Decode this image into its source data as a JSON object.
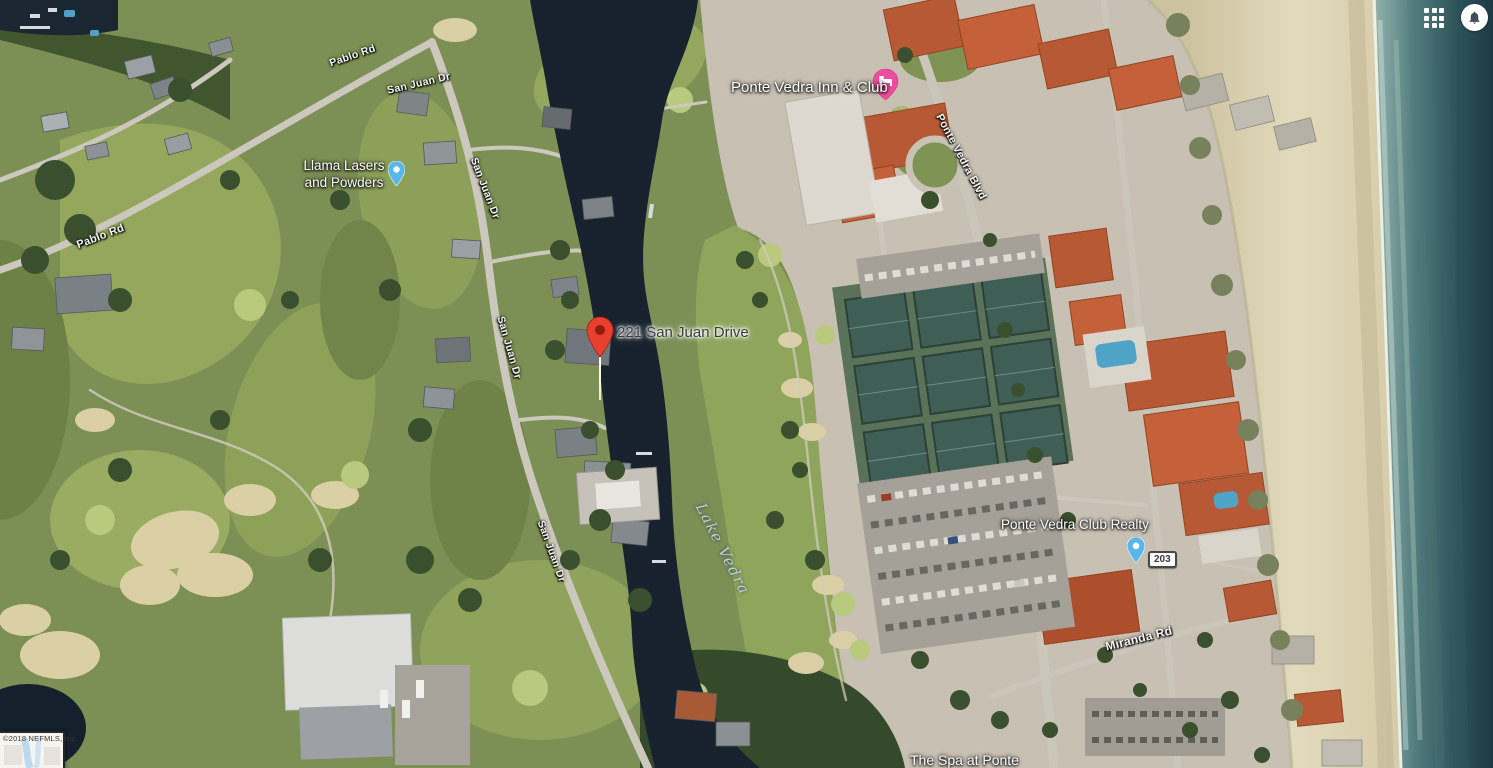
{
  "topbar": {
    "icons": [
      {
        "name": "apps-grid-icon"
      },
      {
        "name": "bell-icon"
      }
    ]
  },
  "map": {
    "marker": {
      "label": "221 San Juan Drive",
      "color": "#e8402d"
    },
    "places": [
      {
        "name": "Ponte Vedra Inn & Club",
        "pin": "lodging-pin-icon",
        "pin_color": "#ee4d9d"
      },
      {
        "name": "Llama Lasers and Powders",
        "line1": "Llama Lasers",
        "line2": "and Powders",
        "pin": "poi-pin-icon",
        "pin_color": "#57b7e8"
      },
      {
        "name": "Ponte Vedra Club Realty",
        "pin": "poi-pin-icon",
        "pin_color": "#57b7e8"
      },
      {
        "name": "The Spa at Ponte",
        "pin": null
      }
    ],
    "roads": {
      "pablo_rd_west": "Pablo Rd",
      "pablo_rd_north": "Pablo Rd",
      "san_juan_dr_top": "San Juan Dr",
      "san_juan_dr_upper": "San Juan Dr",
      "san_juan_dr_mid": "San Juan Dr",
      "san_juan_dr_lower": "San Juan Dr",
      "ponte_vedra_blvd": "Ponte Vedra Blvd",
      "miranda_rd": "Miranda Rd"
    },
    "water": {
      "label": "Lake Vedra"
    },
    "route_shield": {
      "number": "203"
    },
    "attribution": "©2018 NEFMLS, Inc.",
    "terrain_colors": {
      "lagoon": "#17222e",
      "ocean_deep": "#1e3a44",
      "ocean_shallow": "#8fb0aa",
      "beach_sand": "#ddd4b4",
      "golf_green": "#7c8f55",
      "roof_orange": "#b85936",
      "tennis_court": "#3f5e55",
      "road": "#ccc8bd"
    }
  }
}
